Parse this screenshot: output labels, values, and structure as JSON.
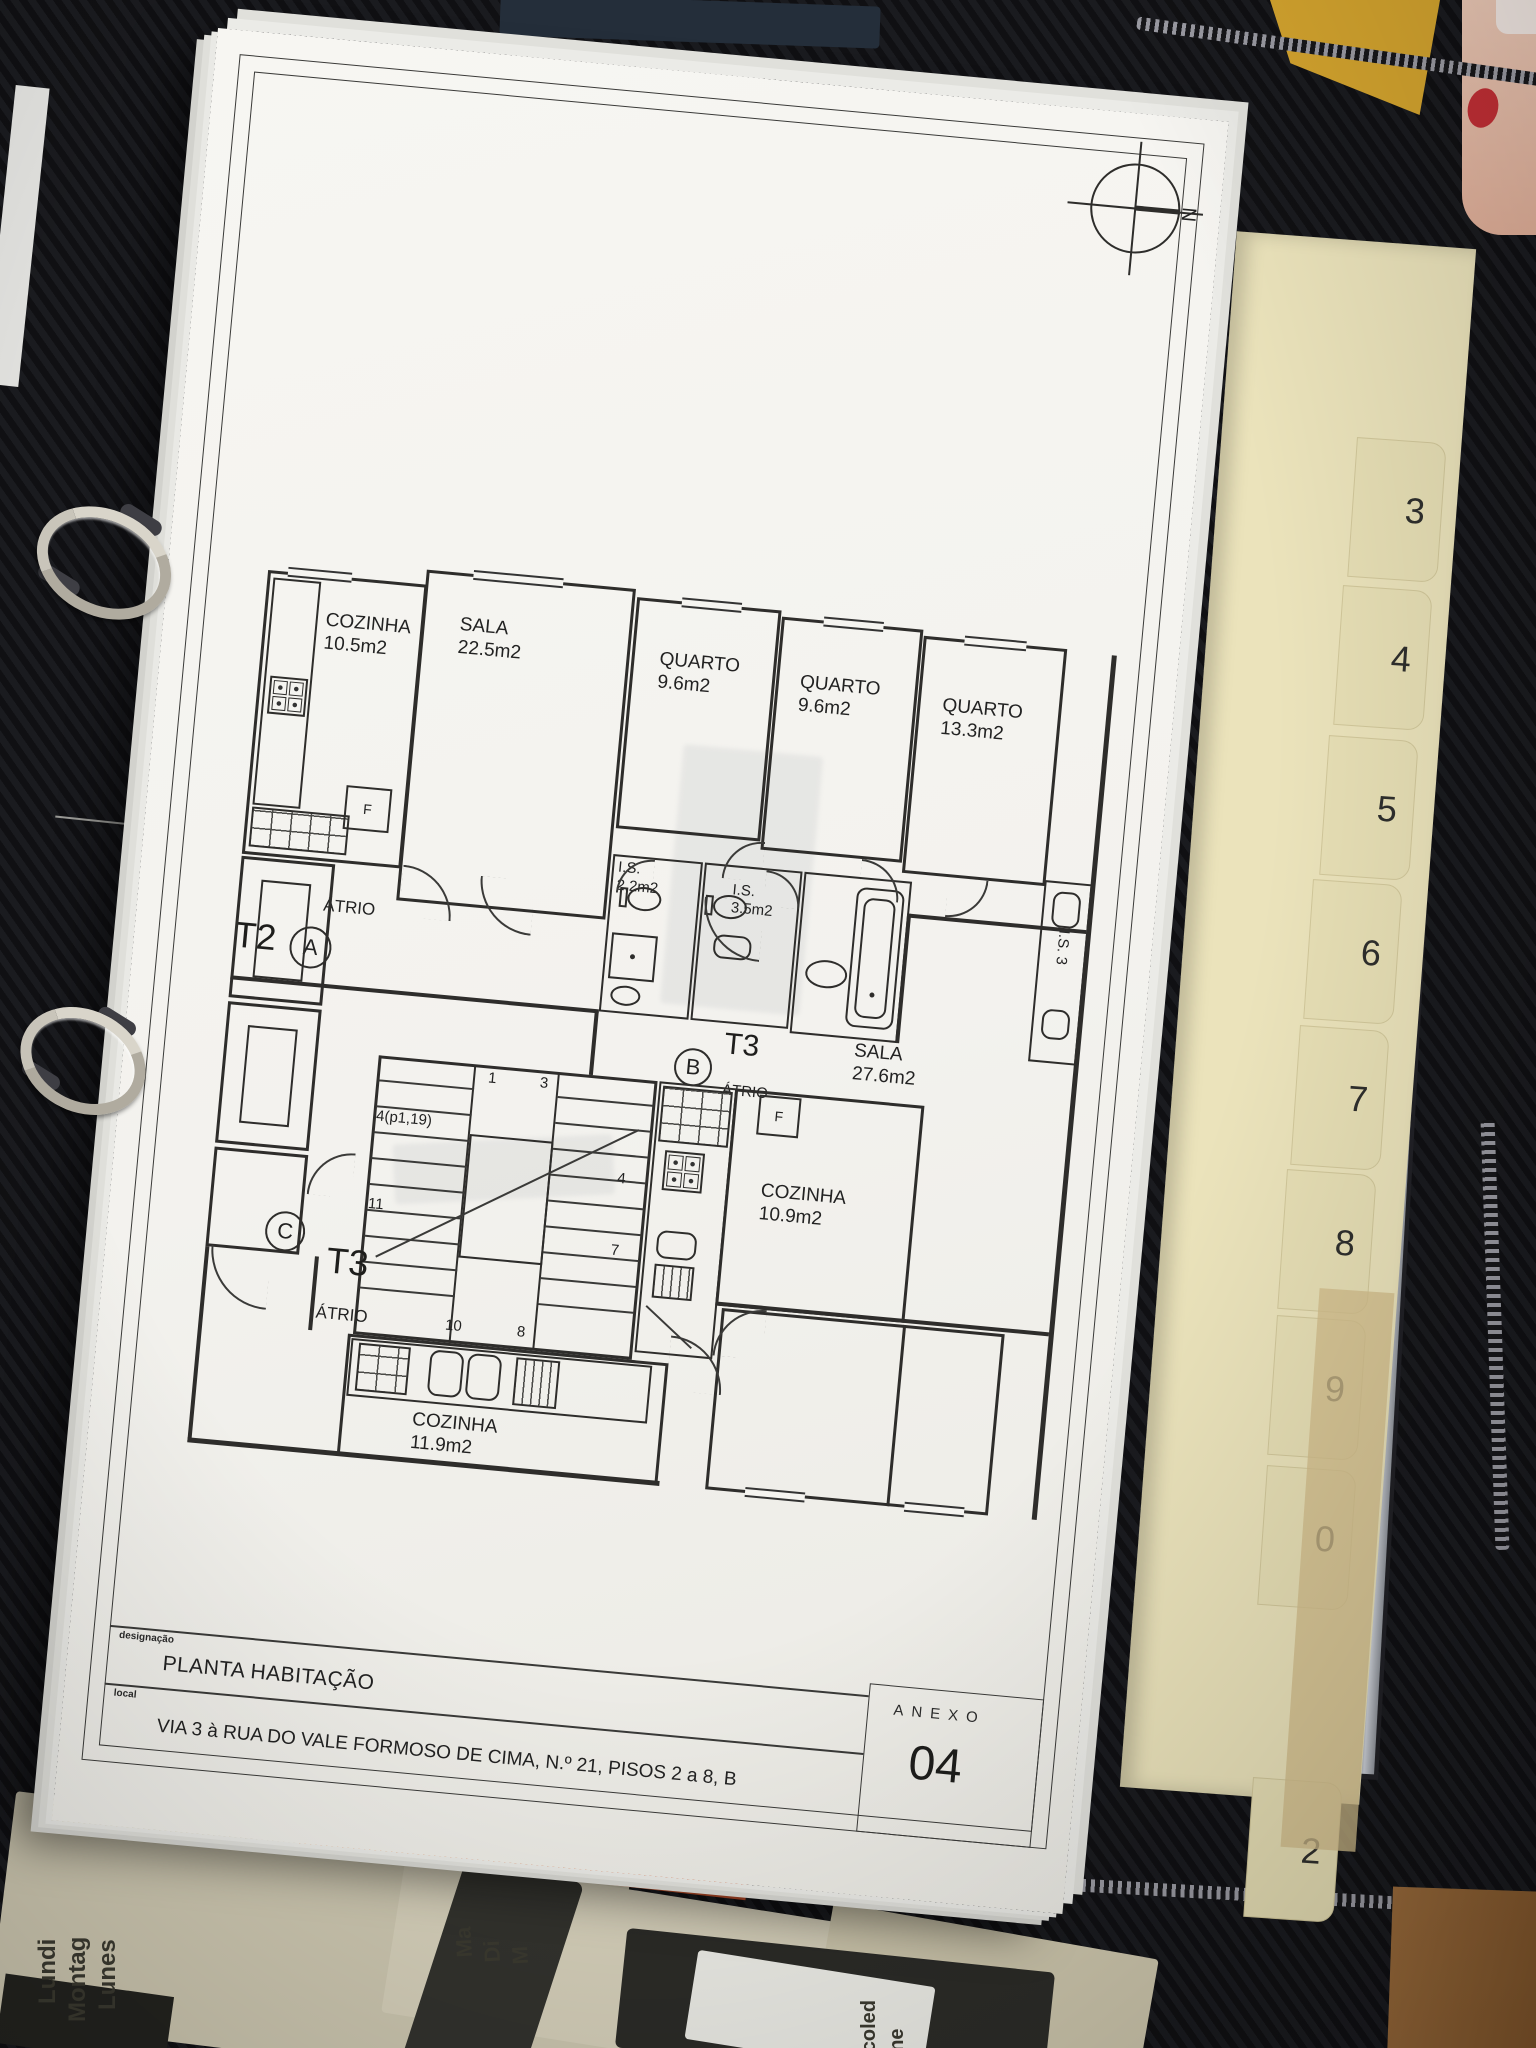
{
  "colors": {
    "paper": "#f5f4f0",
    "ink": "#2e2d2b",
    "tab_cream": "#e7dfb5",
    "case_black": "#141417",
    "bottom_sheet_orange": "#d2622a"
  },
  "sheet": {
    "compass_north": "N",
    "plan": {
      "units": {
        "a": {
          "type": "T2",
          "letter": "A",
          "atrio": "ÁTRIO"
        },
        "b": {
          "type": "T3",
          "letter": "B",
          "atrio": "ÁTRIO"
        },
        "c": {
          "type": "T3",
          "letter": "C",
          "atrio": "ÁTRIO"
        }
      },
      "rooms": {
        "cozinha_a": {
          "name": "COZINHA",
          "area": "10.5m2"
        },
        "sala_a": {
          "name": "SALA",
          "area": "22.5m2"
        },
        "quarto_1": {
          "name": "QUARTO",
          "area": "9.6m2"
        },
        "quarto_2": {
          "name": "QUARTO",
          "area": "9.6m2"
        },
        "quarto_3": {
          "name": "QUARTO",
          "area": "13.3m2"
        },
        "is_1": {
          "name": "I.S.",
          "area": "2.2m2"
        },
        "is_2": {
          "name": "I.S.",
          "area": "3.5m2"
        },
        "is_side": {
          "name": "I.S.",
          "area": "3"
        },
        "sala_b": {
          "name": "SALA",
          "area": "27.6m2"
        },
        "cozinha_b": {
          "name": "COZINHA",
          "area": "10.9m2"
        },
        "cozinha_c": {
          "name": "COZINHA",
          "area": "11.9m2"
        }
      },
      "stairs": {
        "numbers": [
          "1",
          "3",
          "4(p1,19)",
          "4",
          "11",
          "7",
          "10",
          "8"
        ]
      },
      "f_label": "F"
    },
    "title_block": {
      "designacao_label": "designação",
      "designacao_value": "PLANTA HABITAÇÃO",
      "local_label": "local",
      "local_value": "VIA 3 à RUA DO VALE FORMOSO DE CIMA, N.º 21, PISOS 2 a 8, B",
      "anexo_label": "ANEXO",
      "anexo_number": "04"
    }
  },
  "binder": {
    "tabs": [
      "3",
      "4",
      "5",
      "6",
      "7",
      "8",
      "9",
      "0",
      "2"
    ]
  },
  "desk": {
    "planner_monday": [
      "Lundi",
      "Montag",
      "Lunes"
    ],
    "planner_tuesday_partial": [
      "Ma",
      "Di",
      "M"
    ],
    "planner_day_partial": [
      "di",
      "day"
    ],
    "planner_wednesday_partial": [
      "rcoled",
      "dne"
    ]
  }
}
